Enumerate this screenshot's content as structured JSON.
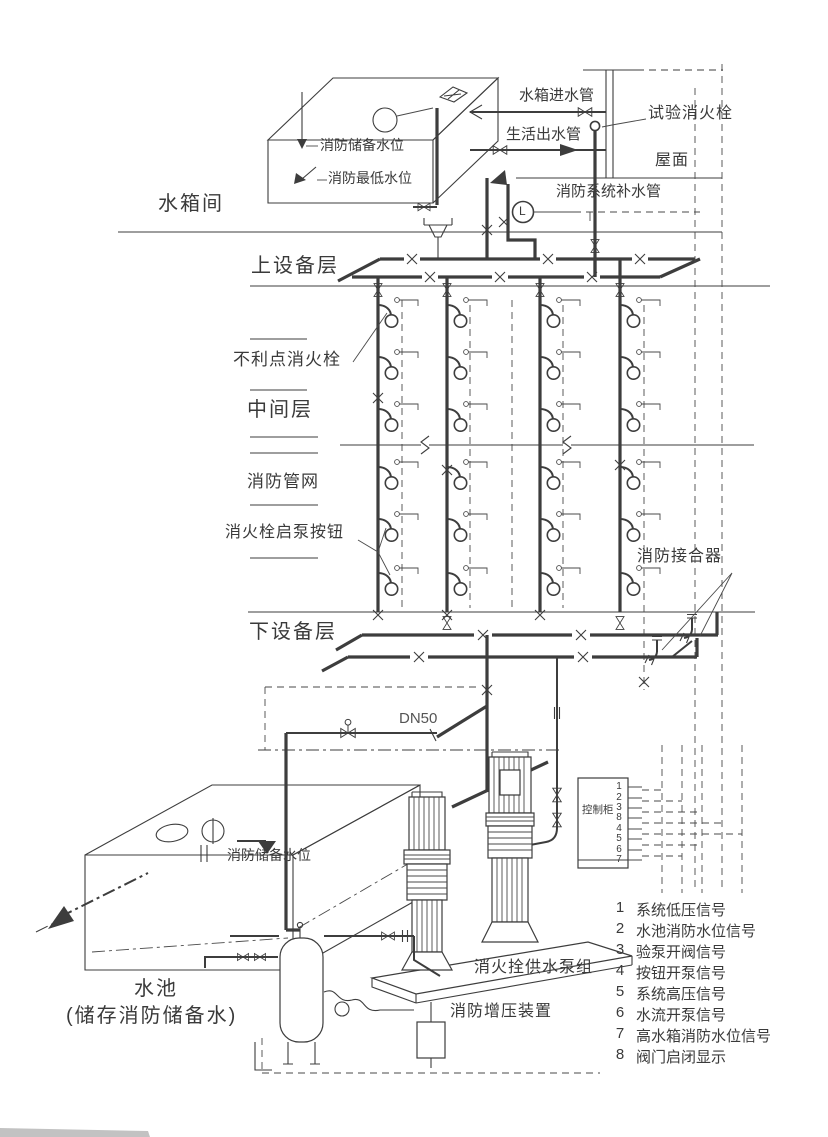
{
  "labels": {
    "tank_inlet_pipe": "水箱进水管",
    "domestic_outlet_pipe": "生活出水管",
    "test_hydrant": "试验消火栓",
    "roof": "屋面",
    "tank_reserve_level": "消防储备水位",
    "tank_lowest_level": "消防最低水位",
    "tank_room": "水箱间",
    "system_makeup_pipe": "消防系统补水管",
    "upper_equipment_floor": "上设备层",
    "unfavorable_hydrant": "不利点消火栓",
    "middle_floor": "中间层",
    "fire_pipe_network": "消防管网",
    "hydrant_pump_start_button": "消火栓启泵按钮",
    "fire_dept_connection": "消防接合器",
    "lower_equipment_floor": "下设备层",
    "pipe_dn50": "DN50",
    "pool_reserve_level": "消防储备水位",
    "pool": "水池",
    "pool_note": "(储存消防储备水)",
    "control_cabinet": "控制柜",
    "level_gauge": "L",
    "hydrant_pump_group": "消火拴供水泵组",
    "pressurization_unit": "消防增压装置"
  },
  "control_cabinet": {
    "terminals": [
      "1",
      "2",
      "3",
      "8",
      "4",
      "5",
      "6",
      "7"
    ]
  },
  "legend": {
    "items": [
      {
        "num": "1",
        "text": "系统低压信号"
      },
      {
        "num": "2",
        "text": "水池消防水位信号"
      },
      {
        "num": "3",
        "text": "验泵开阀信号"
      },
      {
        "num": "4",
        "text": "按钮开泵信号"
      },
      {
        "num": "5",
        "text": "系统高压信号"
      },
      {
        "num": "6",
        "text": "水流开泵信号"
      },
      {
        "num": "7",
        "text": "高水箱消防水位信号"
      },
      {
        "num": "8",
        "text": "阀门启闭显示"
      }
    ]
  },
  "colors": {
    "line": "#3d3d3d",
    "text": "#3a3a3a",
    "background": "#ffffff"
  }
}
